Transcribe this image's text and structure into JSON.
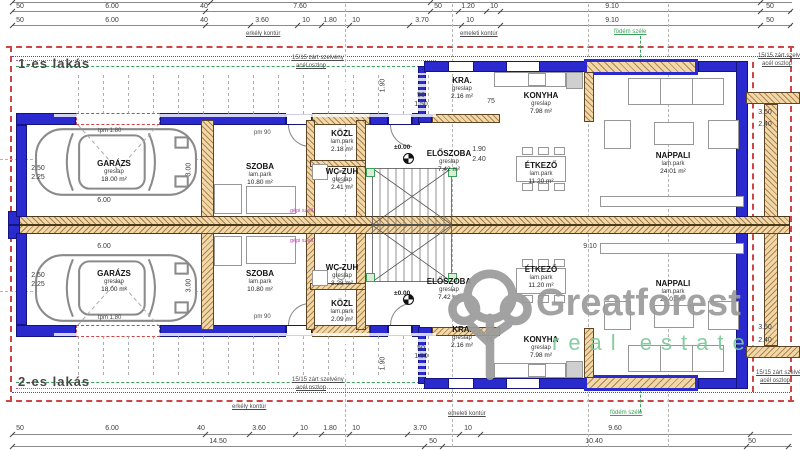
{
  "units": {
    "u1": "1-es lakás",
    "u2": "2-es lakás"
  },
  "watermark": {
    "brand": "Greatforest",
    "tagline": "real estate"
  },
  "rooms": {
    "garaz": {
      "name": "GARÁZS",
      "floor": "greslap",
      "area": "18.00 m²"
    },
    "szoba": {
      "name": "SZOBA",
      "floor": "lam.park",
      "area": "10.80 m²"
    },
    "kozl_u1": {
      "name": "KÖZL",
      "floor": "lam.park",
      "area": "2.18 m²"
    },
    "kozl_u2": {
      "name": "KÖZL",
      "floor": "lam.park",
      "area": "2.09 m²"
    },
    "wc_u1": {
      "name": "WC-ZUH",
      "floor": "greslap",
      "area": "2.41 m²"
    },
    "wc_u2": {
      "name": "WC-ZUH",
      "floor": "greslap",
      "area": "3.28 m²"
    },
    "kra": {
      "name": "KRA.",
      "floor": "greslap",
      "area": "2.16 m²"
    },
    "konyha": {
      "name": "KONYHA",
      "floor": "greslap",
      "area": "7.98 m²"
    },
    "eloszoba": {
      "name": "ELŐSZOBA",
      "floor": "greslap",
      "area": "7.42 m²"
    },
    "etkezo": {
      "name": "ÉTKEZŐ",
      "floor": "lam.park",
      "area": "11.20 m²"
    },
    "nappali": {
      "name": "NAPPALI",
      "floor": "lam.park",
      "area": "24.01 m²"
    }
  },
  "annotations": {
    "erkely": "erkély kontúr",
    "emeleti": "emeleti kontúr",
    "fodem": "födém széle",
    "oszlop_l1": "15/15 zárt szelvény",
    "oszlop_l2": "acél oszlop",
    "pm90": "pm 90",
    "tpm180": "tpm 1.80",
    "level": "±0.00",
    "gepi": "gépi szell."
  },
  "dims": {
    "top1": [
      "50",
      "6.00",
      "40",
      "7.60",
      "50",
      "1.20",
      "10",
      "9.10",
      "50"
    ],
    "top2": [
      "50",
      "6.00",
      "40",
      "3.60",
      "10",
      "1.80",
      "10",
      "3.70",
      "10",
      "9.10",
      "50"
    ],
    "bottom1": [
      "50",
      "6.00",
      "40",
      "3.60",
      "10",
      "1.80",
      "10",
      "3.70",
      "10",
      "9.60"
    ],
    "bottom2": [
      "14.50",
      "50",
      "10.40",
      "50"
    ],
    "inner": {
      "garage_len": "6.00",
      "garage_dep": "3.00",
      "car_w1": "2.50",
      "car_w2": "2.25",
      "kra_a": "50",
      "kra_b": "1.50",
      "k75": "75",
      "elo_a": "1.90",
      "elo_b": "2.40",
      "nap": "9.10",
      "right_a": "3.50",
      "right_b": "2.40",
      "stair": "1.90"
    }
  },
  "colors": {
    "wall_blue": "#2a2ace",
    "hatch": "#b08448",
    "contour_red": "#cf4545",
    "contour_green": "#3aa05a",
    "brand_gray": "#9b9b9b",
    "brand_green": "#7cc99a"
  }
}
